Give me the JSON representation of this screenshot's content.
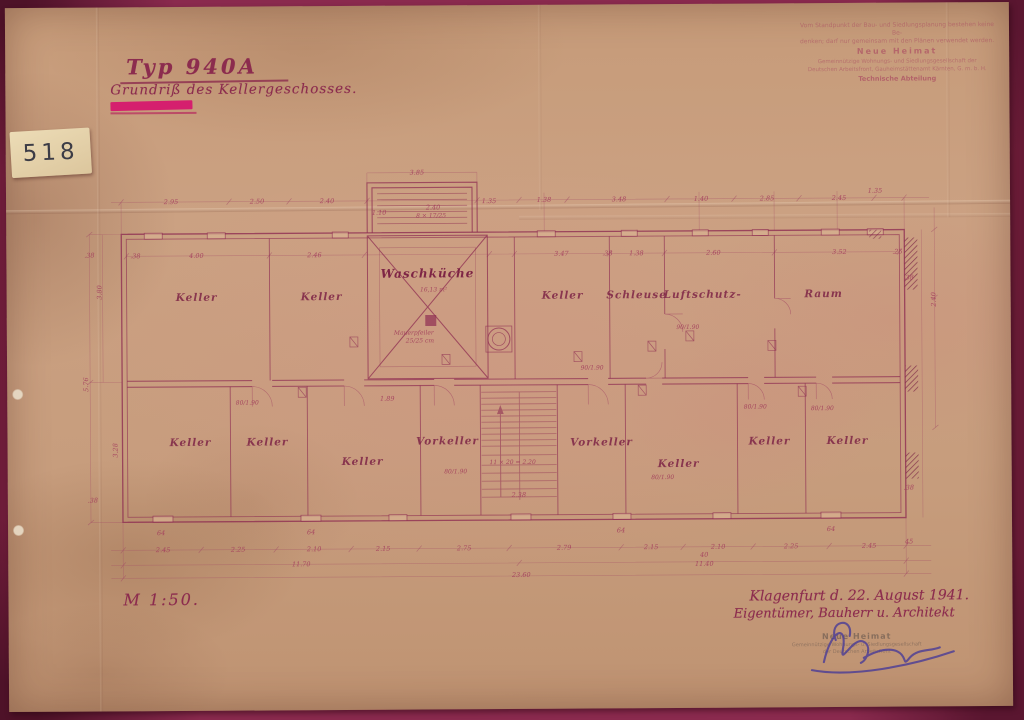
{
  "archive_label": {
    "number": "518"
  },
  "title": {
    "line1": "Typ 940A",
    "line2": "Grundriß des Kellergeschosses."
  },
  "stamp_top_right": {
    "lines": [
      "Vom Standpunkt der Bau- und Siedlungsplanung bestehen keine Be-",
      "denken; darf nur gemeinsam mit den Plänen verwendet werden.",
      "Neue Heimat",
      "Gemeinnützige Wohnungs- und Siedlungsgesellschaft der",
      "Deutschen Arbeitsfront, Gauheimstättenamt Kärnten, G. m. b. H.",
      "Technische Abteilung"
    ]
  },
  "scale": {
    "text": "M 1:50."
  },
  "footer": {
    "place_date": "Klagenfurt d. 22. August 1941.",
    "parties": "Eigentümer, Bauherr u. Architekt",
    "stamp_lines": [
      "Neue Heimat",
      "Gemeinnützige Wohnungs- u. Siedlungsgesellschaft",
      "der Deutschen Arbeitsfront"
    ],
    "signature": "Kraus"
  },
  "plan": {
    "rooms": [
      {
        "t": "Keller",
        "x": 197,
        "y": 299
      },
      {
        "t": "Keller",
        "x": 322,
        "y": 299
      },
      {
        "t": "Waschküche",
        "x": 428,
        "y": 277,
        "c": "room-big"
      },
      {
        "t": "Keller",
        "x": 563,
        "y": 299
      },
      {
        "t": "Schleuse",
        "x": 637,
        "y": 299
      },
      {
        "t": "Luftschutz-",
        "x": 703,
        "y": 299
      },
      {
        "t": "Raum",
        "x": 824,
        "y": 299
      },
      {
        "t": "Keller",
        "x": 190,
        "y": 444
      },
      {
        "t": "Keller",
        "x": 267,
        "y": 444
      },
      {
        "t": "Keller",
        "x": 362,
        "y": 464
      },
      {
        "t": "Vorkeller",
        "x": 447,
        "y": 444
      },
      {
        "t": "Vorkeller",
        "x": 601,
        "y": 446
      },
      {
        "t": "Keller",
        "x": 678,
        "y": 468
      },
      {
        "t": "Keller",
        "x": 769,
        "y": 446
      },
      {
        "t": "Keller",
        "x": 847,
        "y": 446
      }
    ],
    "dimensions": [
      {
        "x": 172,
        "y": 202,
        "t": "2.95"
      },
      {
        "x": 258,
        "y": 202,
        "t": "2.50"
      },
      {
        "x": 328,
        "y": 202,
        "t": "2.40"
      },
      {
        "x": 545,
        "y": 202,
        "t": "1.38"
      },
      {
        "x": 620,
        "y": 202,
        "t": "3.48"
      },
      {
        "x": 702,
        "y": 202,
        "t": "1.40"
      },
      {
        "x": 768,
        "y": 202,
        "t": "2.85"
      },
      {
        "x": 840,
        "y": 202,
        "t": "2.45"
      },
      {
        "x": 876,
        "y": 195,
        "t": "1.35"
      },
      {
        "x": 418,
        "y": 174,
        "t": "3.85"
      },
      {
        "x": 434,
        "y": 209,
        "t": "2.40"
      },
      {
        "x": 432,
        "y": 217,
        "t": "8 × 17/25",
        "c": "note"
      },
      {
        "x": 380,
        "y": 214,
        "t": "1.10"
      },
      {
        "x": 490,
        "y": 203,
        "t": "1.35"
      },
      {
        "x": 197,
        "y": 256,
        "t": "4.00"
      },
      {
        "x": 315,
        "y": 256,
        "t": "2.46"
      },
      {
        "x": 562,
        "y": 256,
        "t": "3.47"
      },
      {
        "x": 637,
        "y": 256,
        "t": "1.38"
      },
      {
        "x": 714,
        "y": 256,
        "t": "2.60"
      },
      {
        "x": 840,
        "y": 256,
        "t": "3.52"
      },
      {
        "x": 136,
        "y": 256,
        "t": ".38"
      },
      {
        "x": 608,
        "y": 256,
        "t": ".38"
      },
      {
        "x": 898,
        "y": 256,
        "t": ".25"
      },
      {
        "x": 88,
        "y": 382,
        "t": "5.76",
        "r": -90
      },
      {
        "x": 102,
        "y": 290,
        "t": "3.80",
        "r": -90
      },
      {
        "x": 117,
        "y": 448,
        "t": "3.28",
        "r": -90
      },
      {
        "x": 90,
        "y": 255,
        "t": ".38"
      },
      {
        "x": 92,
        "y": 500,
        "t": ".38"
      },
      {
        "x": 936,
        "y": 302,
        "t": "2.40",
        "r": -90
      },
      {
        "x": 909,
        "y": 282,
        "t": ".38"
      },
      {
        "x": 908,
        "y": 492,
        "t": ".38"
      },
      {
        "x": 908,
        "y": 546,
        "t": "45"
      },
      {
        "x": 162,
        "y": 550,
        "t": "2.45"
      },
      {
        "x": 237,
        "y": 550,
        "t": "2.25"
      },
      {
        "x": 313,
        "y": 550,
        "t": "2.10"
      },
      {
        "x": 382,
        "y": 550,
        "t": "2.15"
      },
      {
        "x": 463,
        "y": 550,
        "t": "2.75"
      },
      {
        "x": 563,
        "y": 550,
        "t": "2.79"
      },
      {
        "x": 650,
        "y": 550,
        "t": "2.15"
      },
      {
        "x": 717,
        "y": 550,
        "t": "2.10"
      },
      {
        "x": 790,
        "y": 550,
        "t": "2.25"
      },
      {
        "x": 868,
        "y": 550,
        "t": "2.45"
      },
      {
        "x": 300,
        "y": 565,
        "t": "11.70"
      },
      {
        "x": 703,
        "y": 558,
        "t": "40"
      },
      {
        "x": 703,
        "y": 567,
        "t": "11.40"
      },
      {
        "x": 520,
        "y": 577,
        "t": "23.60"
      },
      {
        "x": 160,
        "y": 533,
        "t": "64"
      },
      {
        "x": 310,
        "y": 533,
        "t": "64"
      },
      {
        "x": 620,
        "y": 533,
        "t": "64"
      },
      {
        "x": 830,
        "y": 533,
        "t": "64"
      },
      {
        "x": 247,
        "y": 403,
        "t": "80/1.90",
        "c": "note"
      },
      {
        "x": 592,
        "y": 370,
        "t": "90/1.90",
        "c": "note"
      },
      {
        "x": 688,
        "y": 330,
        "t": "90/1.90",
        "c": "note"
      },
      {
        "x": 755,
        "y": 410,
        "t": "80/1.90",
        "c": "note"
      },
      {
        "x": 822,
        "y": 412,
        "t": "80/1.90",
        "c": "note"
      },
      {
        "x": 455,
        "y": 473,
        "t": "80/1.90",
        "c": "note"
      },
      {
        "x": 662,
        "y": 480,
        "t": "80/1.90",
        "c": "note"
      },
      {
        "x": 387,
        "y": 400,
        "t": "1.89"
      },
      {
        "x": 512,
        "y": 464,
        "t": "11 × 20 = 2.20",
        "c": "note"
      },
      {
        "x": 518,
        "y": 497,
        "t": "2.38"
      },
      {
        "x": 434,
        "y": 291,
        "t": "16,13 m²",
        "c": "note"
      },
      {
        "x": 414,
        "y": 334,
        "t": "Mauerpfeiler",
        "c": "note"
      },
      {
        "x": 420,
        "y": 342,
        "t": "25/25 cm",
        "c": "note"
      }
    ]
  }
}
